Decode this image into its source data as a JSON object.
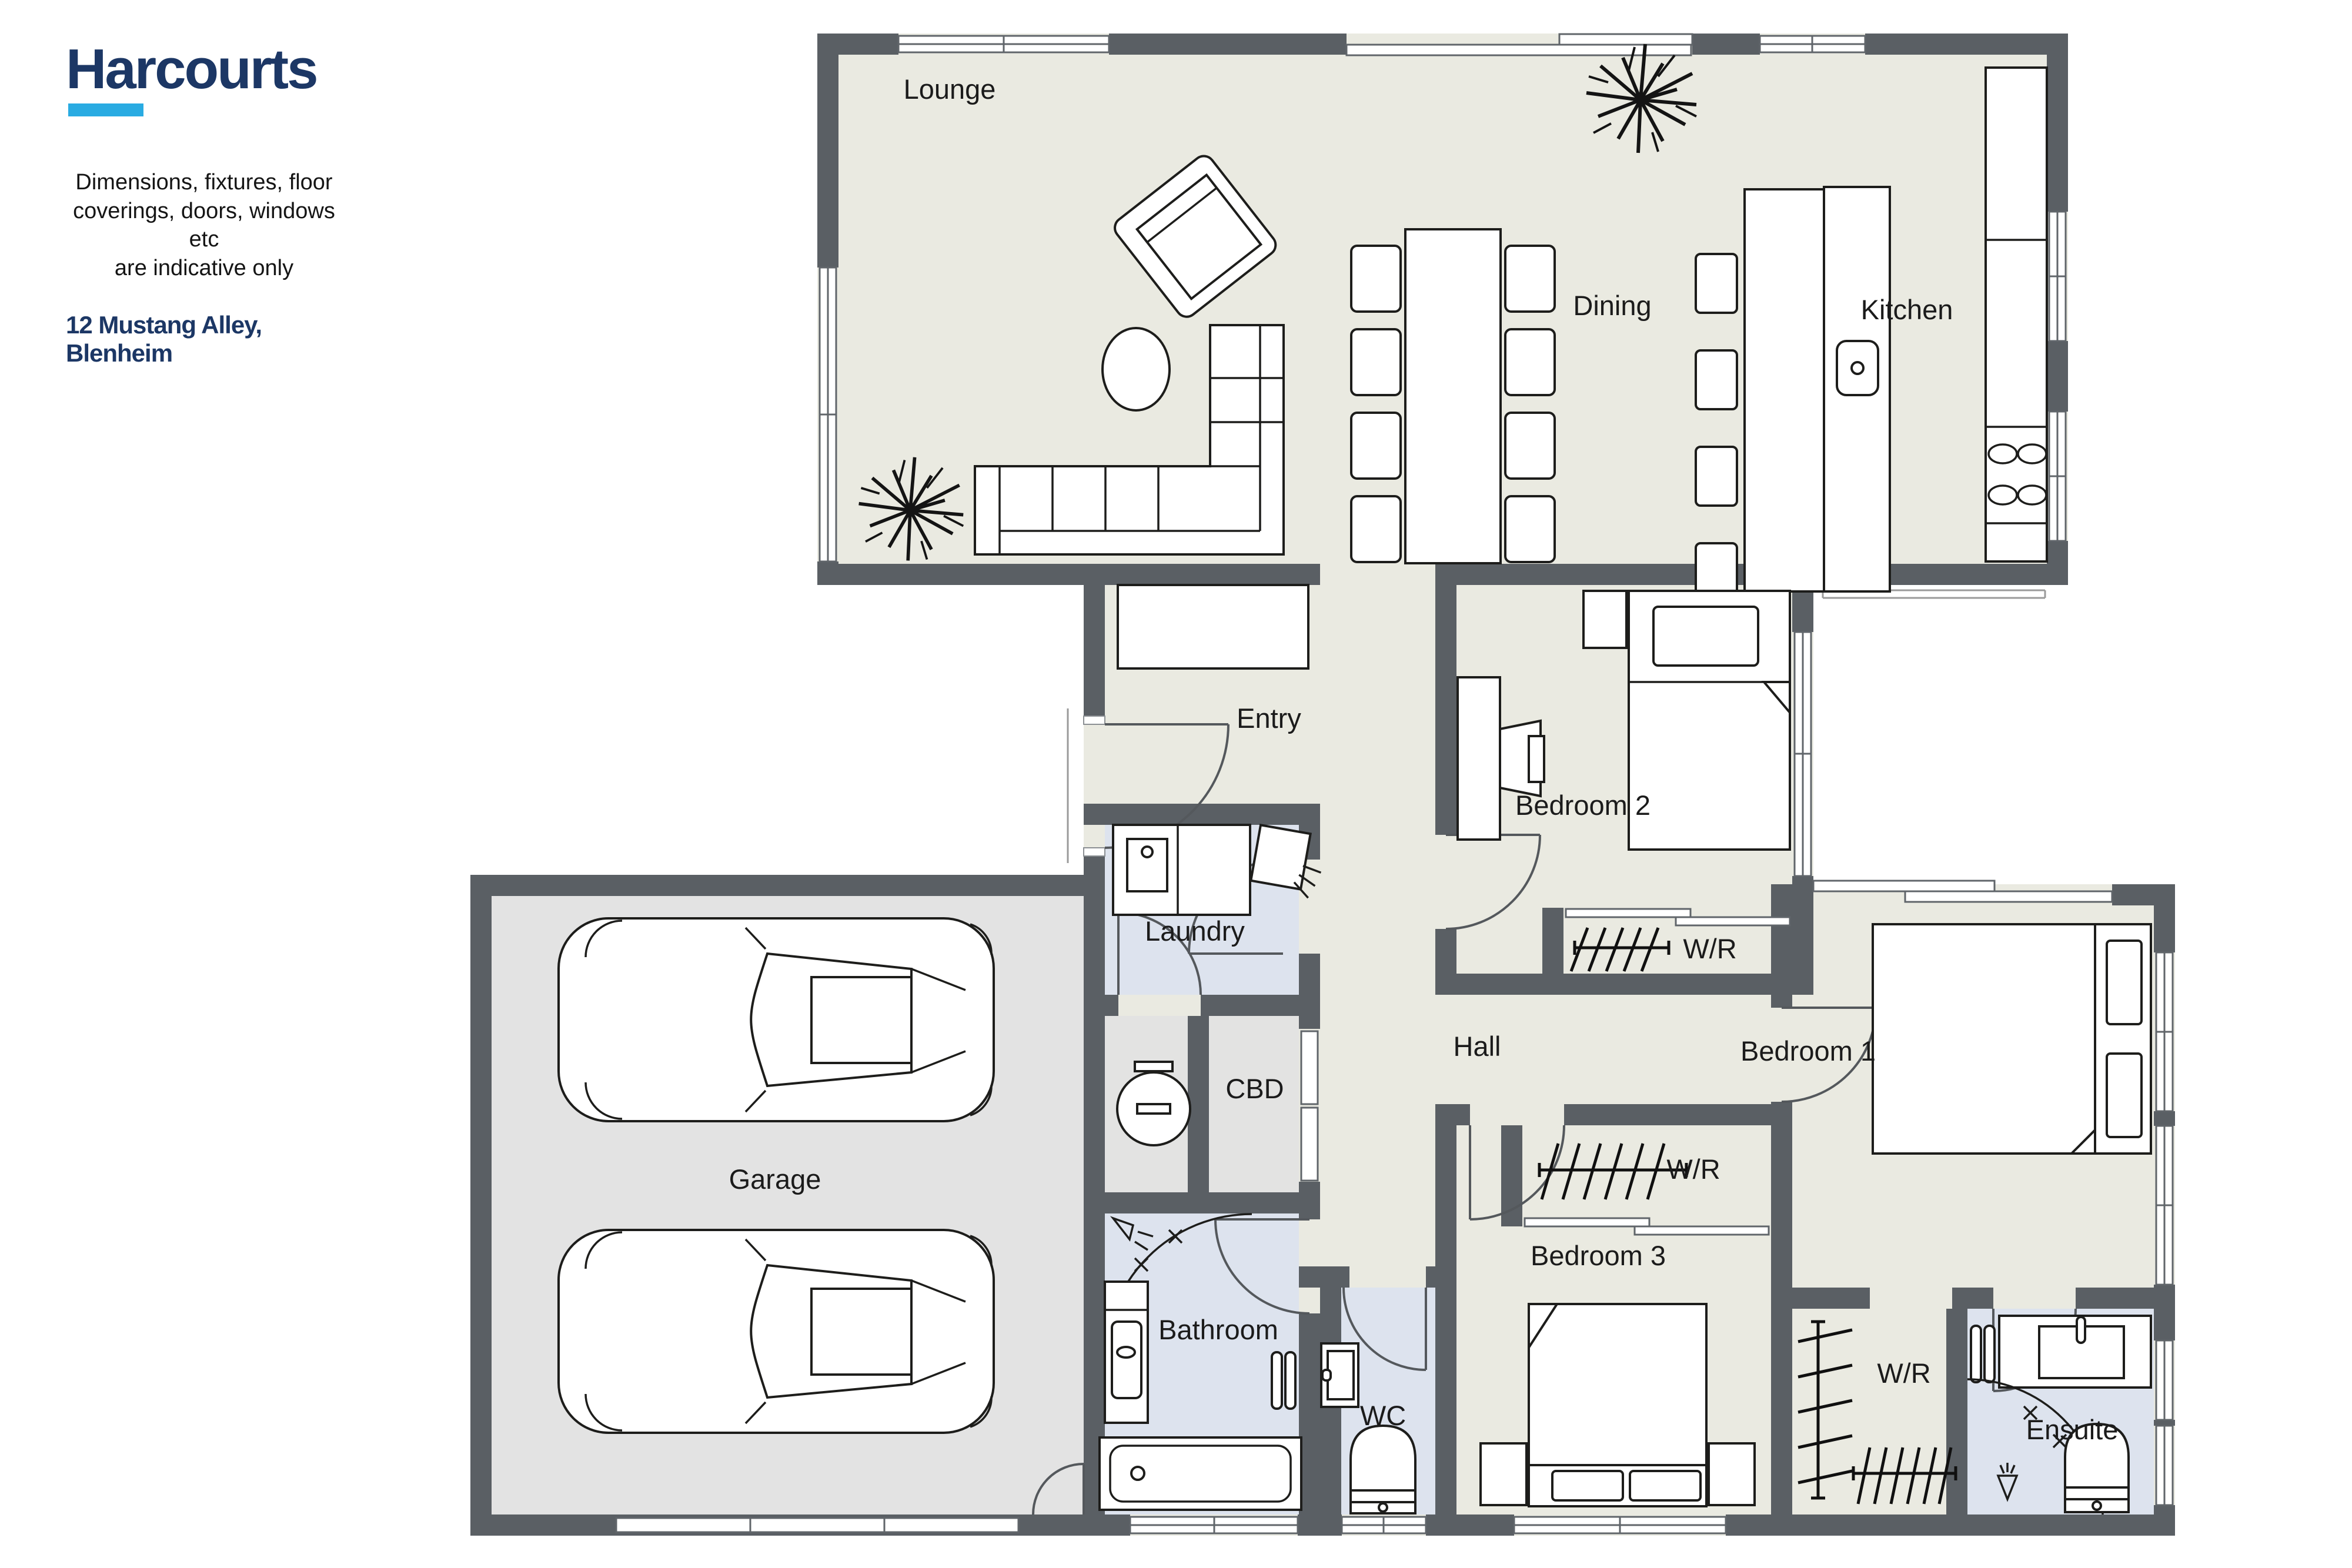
{
  "branding": {
    "logo": "Harcourts",
    "disclaimer": [
      "Dimensions, fixtures, floor",
      "coverings, doors, windows etc",
      "are indicative only"
    ],
    "address": "12 Mustang Alley, Blenheim"
  },
  "rooms": {
    "lounge": "Lounge",
    "dining": "Dining",
    "kitchen": "Kitchen",
    "entry": "Entry",
    "laundry": "Laundry",
    "cbd": "CBD",
    "hall": "Hall",
    "bedroom2": "Bedroom 2",
    "wr_bedroom2": "W/R",
    "bedroom1": "Bedroom 1",
    "wr_bedroom3": "W/R",
    "bedroom3": "Bedroom 3",
    "wr_bedroom1": "W/R",
    "ensuite": "Ensuite",
    "wc": "WC",
    "bathroom": "Bathroom",
    "garage": "Garage"
  },
  "colors": {
    "brand": "#1c3765",
    "accent": "#29abe2",
    "wall": "#5a5f64",
    "floor_main": "#eaeae1",
    "floor_garage": "#e3e3e3",
    "floor_wet": "#dde3ee",
    "floor_store": "#e3e3e2"
  }
}
